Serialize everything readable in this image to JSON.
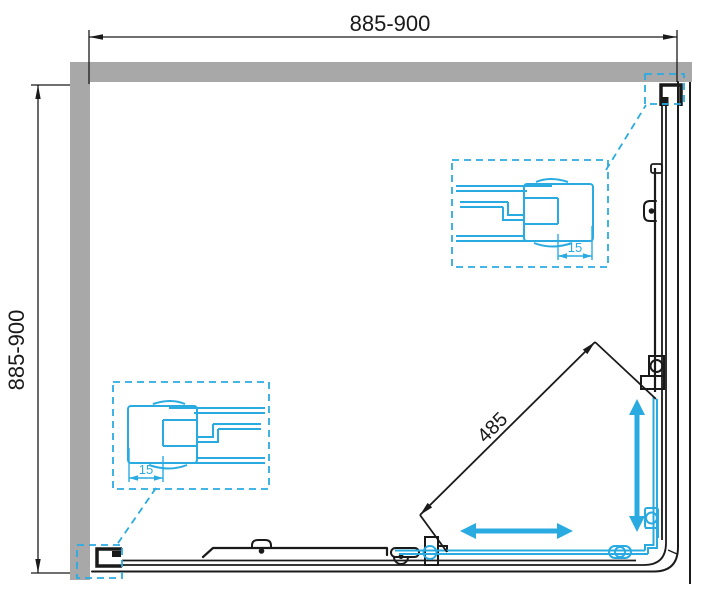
{
  "drawing": {
    "title": "corner-shower-enclosure-plan-view",
    "dimensions": {
      "width_range": "885-900",
      "depth_range": "885-900",
      "entry_diagonal": "485",
      "profile_adjust_top": "15",
      "profile_adjust_bottom": "15"
    },
    "colors": {
      "wall_gray": "#a8a8a8",
      "line_black": "#1a1a1a",
      "accent_cyan": "#29abe2",
      "background": "#ffffff"
    }
  }
}
